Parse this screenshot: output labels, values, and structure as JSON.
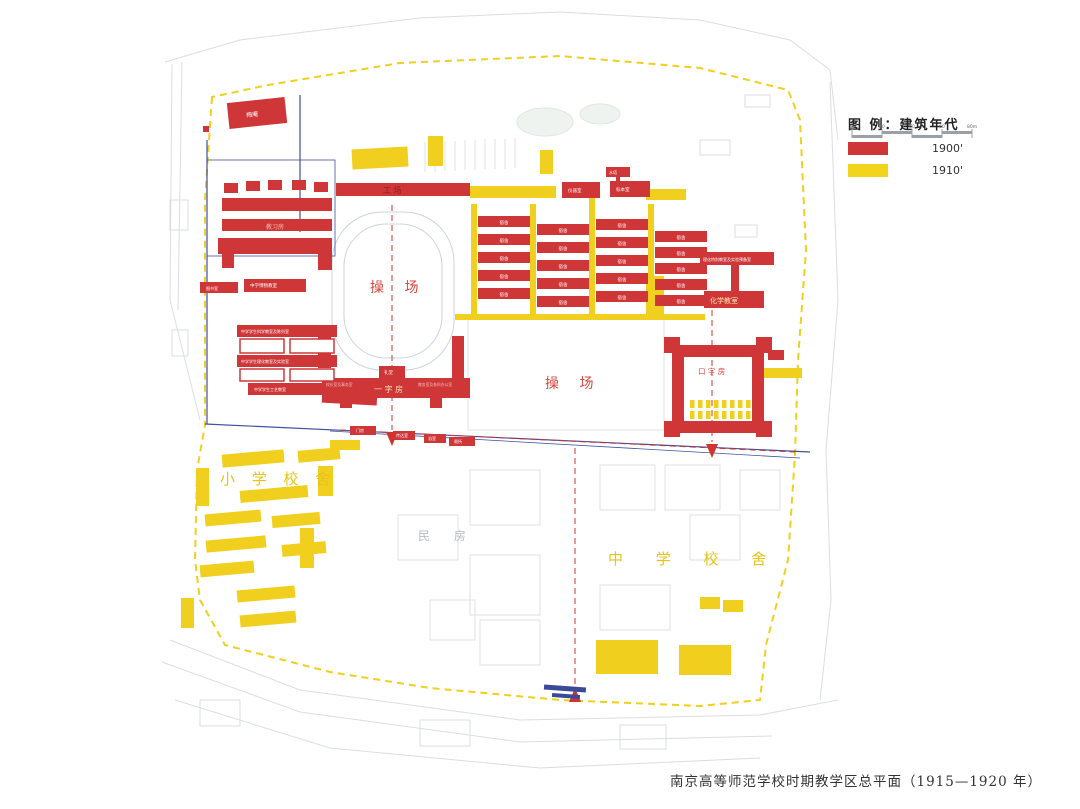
{
  "caption": "南京高等师范学校时期教学区总平面（1915—1920 年）",
  "legend": {
    "title": "图 例：建筑年代",
    "items": [
      {
        "name": "era-1900s",
        "label": "1900'",
        "color": "#cf3638"
      },
      {
        "name": "era-1910s",
        "label": "1910'",
        "color": "#f2d41c"
      }
    ],
    "scale_ticks": [
      "0",
      "20",
      "40",
      "60",
      "80m"
    ]
  },
  "colors": {
    "building_1900": "#cf3638",
    "building_1910": "#f2d41c",
    "boundary_dash": "#f0cf1e",
    "axis_dash": "#d0342c",
    "road_blue": "#3f51a0",
    "sketch_gray": "#d8dce0"
  },
  "map": {
    "meian": "梅庵",
    "jiaoxifang": "教习房",
    "gongchang": "工  场",
    "playground1": "操  场",
    "playground2": "操  场",
    "chem": "化学教室",
    "lab_row": "理化特别教室及实验预备室",
    "kouzifang": "口 字 房",
    "yizifang": "一  字  房",
    "primary_school": "小 学 校 舍",
    "middle_school": "中 学 校 舍",
    "minfang": "民  房",
    "dorm": "宿舍",
    "left_bar1": "中学学生科学教室及陈列室",
    "left_bar2": "中学学生理化教室及实验室",
    "left_bar3": "中学学生工艺教室",
    "small_a": "图书室",
    "small_b": "中学博物教室",
    "top_a": "仪器室",
    "top_b": "标本室",
    "top_c": "水塔",
    "stub_hall": "礼堂",
    "wing_left": "校长室及事务室",
    "wing_right": "教务室及各科办公室",
    "gate_a": "门房",
    "gate_b": "传达室",
    "gate_c": "浴室",
    "gate_d": "厕所"
  }
}
